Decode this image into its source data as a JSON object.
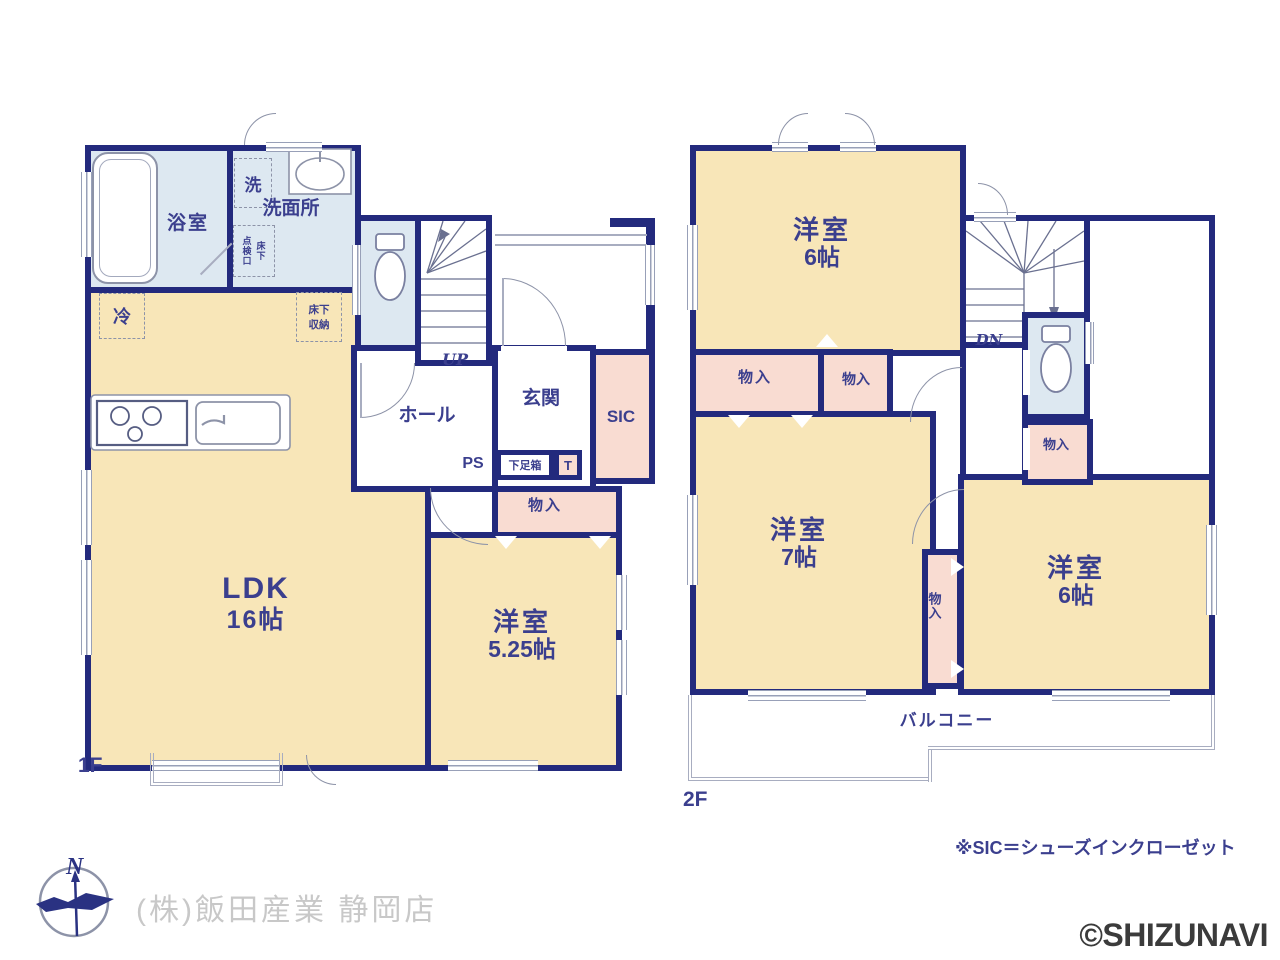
{
  "floor1": {
    "label": "1F",
    "bathroom": "浴室",
    "washroom": "洗面所",
    "laundry": "洗",
    "inspection_left": "点検口",
    "inspection_right": "床下",
    "fridge": "冷",
    "underfloor_1": "床下",
    "underfloor_2": "収納",
    "stairs": "UP",
    "hall": "ホール",
    "entrance": "玄関",
    "sic": "SIC",
    "ps": "PS",
    "shoe_box": "下足箱",
    "toilet_t": "T",
    "closet": "物入",
    "ldk": {
      "name": "LDK",
      "size": "16帖"
    },
    "western": {
      "name": "洋室",
      "size": "5.25帖"
    }
  },
  "floor2": {
    "label": "2F",
    "western_top": {
      "name": "洋室",
      "size": "6帖"
    },
    "stairs": "DN",
    "closet_wide": "物入",
    "closet_small": "物入",
    "closet_side": "物入",
    "closet_vertical": "物入",
    "western_left": {
      "name": "洋室",
      "size": "7帖"
    },
    "western_right": {
      "name": "洋室",
      "size": "6帖"
    },
    "balcony": "バルコニー"
  },
  "footer": {
    "compass_north": "N",
    "company": "(株)飯田産業 静岡店",
    "sic_note": "※SIC＝シューズインクローゼット",
    "watermark": "©SHIZUNAVI"
  },
  "colors": {
    "wall": "#232a7d",
    "room_cream": "#f8e6b8",
    "closet_pink": "#f9dcd2",
    "wet_area_blue": "#dde8f1",
    "label_navy": "#3b3f8e",
    "line_gray": "#98a0b8",
    "company_gray": "#c8c8c8",
    "watermark_gray": "#3b3b3b"
  }
}
